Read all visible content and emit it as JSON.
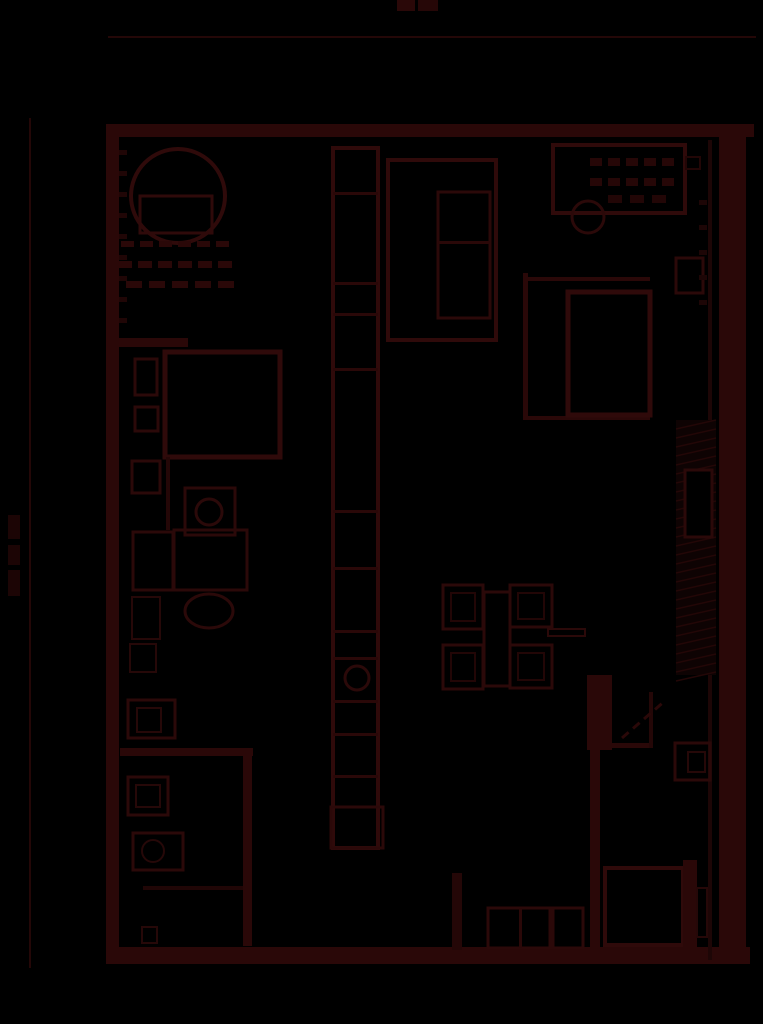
{
  "canvas": {
    "width": 763,
    "height": 1024,
    "background": "#000000"
  },
  "palette": {
    "wall_fill": "#2a0808",
    "line_strong": "#2f0a0a",
    "line_mid": "#2b0909",
    "line_soft": "#260808",
    "line_faint": "#1f0606",
    "hairline": "#240707",
    "blob": "#1c0505",
    "cavity_bg": "#0e0303"
  },
  "annotations": {
    "title_blob_legible": false,
    "left_dimension_label_legible": false
  },
  "shapes": [
    {
      "name": "title-blob-1",
      "kind": "rect",
      "x": 397,
      "y": 0,
      "w": 18,
      "h": 11,
      "f": "#2a0808"
    },
    {
      "name": "title-blob-2",
      "kind": "rect",
      "x": 418,
      "y": 0,
      "w": 20,
      "h": 11,
      "f": "#260707"
    },
    {
      "name": "top-dimension-rule",
      "kind": "rect",
      "x": 108,
      "y": 36,
      "w": 648,
      "h": 2,
      "f": "#240707"
    },
    {
      "name": "left-dimension-line",
      "kind": "rect",
      "x": 29,
      "y": 118,
      "w": 2,
      "h": 850,
      "f": "#240707"
    },
    {
      "name": "left-dimension-label-1",
      "kind": "rect",
      "x": 8,
      "y": 515,
      "w": 12,
      "h": 24,
      "f": "#1c0505"
    },
    {
      "name": "left-dimension-label-2",
      "kind": "rect",
      "x": 8,
      "y": 545,
      "w": 12,
      "h": 20,
      "f": "#1c0505"
    },
    {
      "name": "left-dimension-label-3",
      "kind": "rect",
      "x": 8,
      "y": 570,
      "w": 12,
      "h": 26,
      "f": "#1c0505"
    },
    {
      "name": "wall-top",
      "kind": "rect",
      "x": 108,
      "y": 124,
      "w": 646,
      "h": 13,
      "f": "#2a0808"
    },
    {
      "name": "wall-left",
      "kind": "rect",
      "x": 106,
      "y": 124,
      "w": 13,
      "h": 840,
      "f": "#2a0808"
    },
    {
      "name": "wall-bottom",
      "kind": "rect",
      "x": 106,
      "y": 947,
      "w": 644,
      "h": 17,
      "f": "#2a0808"
    },
    {
      "name": "wall-right",
      "kind": "rect",
      "x": 719,
      "y": 124,
      "w": 27,
      "h": 840,
      "f": "#2a0808"
    },
    {
      "name": "wall-right-inner-line",
      "kind": "rect",
      "x": 708,
      "y": 140,
      "w": 4,
      "h": 820,
      "f": "#1d0606"
    },
    {
      "name": "left-wall-hatch-ticks",
      "kind": "vdashrow",
      "x": 119,
      "y": 150,
      "n": 9,
      "dh": 5,
      "gap": 16,
      "w": 8,
      "f": "#200606"
    },
    {
      "name": "basin-circle",
      "kind": "circle",
      "cx": 178,
      "cy": 196,
      "r": 47,
      "s": "#2f0a0a",
      "sw": 4
    },
    {
      "name": "basin-counter",
      "kind": "rect",
      "x": 140,
      "y": 196,
      "w": 72,
      "h": 37,
      "s": "#2f0a0a",
      "sw": 3
    },
    {
      "name": "tile-dashes-row-1",
      "kind": "dashrow",
      "x": 121,
      "y": 241,
      "n": 6,
      "dw": 13,
      "gap": 6,
      "h": 6,
      "f": "#2a0808"
    },
    {
      "name": "tile-dashes-row-2",
      "kind": "dashrow",
      "x": 118,
      "y": 261,
      "n": 6,
      "dw": 14,
      "gap": 6,
      "h": 7,
      "f": "#2a0808"
    },
    {
      "name": "tile-dashes-row-3",
      "kind": "dashrow",
      "x": 126,
      "y": 281,
      "n": 5,
      "dw": 16,
      "gap": 7,
      "h": 7,
      "f": "#2a0808"
    },
    {
      "name": "partition-wall-a",
      "kind": "rect",
      "x": 118,
      "y": 338,
      "w": 70,
      "h": 9,
      "f": "#2a0808"
    },
    {
      "name": "closet-square",
      "kind": "rect",
      "x": 165,
      "y": 352,
      "w": 115,
      "h": 105,
      "s": "#2f0a0a",
      "sw": 5
    },
    {
      "name": "wall-shelf-1",
      "kind": "rect",
      "x": 135,
      "y": 359,
      "w": 22,
      "h": 36,
      "s": "#2b0909",
      "sw": 3
    },
    {
      "name": "wall-shelf-2",
      "kind": "rect",
      "x": 135,
      "y": 407,
      "w": 23,
      "h": 24,
      "s": "#2b0909",
      "sw": 3
    },
    {
      "name": "wall-shelf-3",
      "kind": "rect",
      "x": 132,
      "y": 461,
      "w": 28,
      "h": 32,
      "s": "#2b0909",
      "sw": 3
    },
    {
      "name": "closet-stem-line",
      "kind": "rect",
      "x": 166,
      "y": 457,
      "w": 4,
      "h": 73,
      "f": "#240707"
    },
    {
      "name": "fixture-box",
      "kind": "rect",
      "x": 185,
      "y": 488,
      "w": 50,
      "h": 47,
      "s": "#2b0909",
      "sw": 3
    },
    {
      "name": "fixture-box-circle",
      "kind": "circle",
      "cx": 209,
      "cy": 512,
      "r": 13,
      "s": "#2b0909",
      "sw": 3
    },
    {
      "name": "cabinet-1",
      "kind": "rect",
      "x": 133,
      "y": 532,
      "w": 40,
      "h": 58,
      "s": "#2b0909",
      "sw": 3
    },
    {
      "name": "cabinet-2",
      "kind": "rect",
      "x": 174,
      "y": 530,
      "w": 73,
      "h": 60,
      "s": "#2b0909",
      "sw": 3
    },
    {
      "name": "oval-fixture",
      "kind": "ellipse",
      "cx": 209,
      "cy": 611,
      "rx": 24,
      "ry": 17,
      "s": "#2b0909",
      "sw": 3
    },
    {
      "name": "cabinet-3",
      "kind": "rect",
      "x": 132,
      "y": 597,
      "w": 28,
      "h": 42,
      "s": "#260808",
      "sw": 2
    },
    {
      "name": "cabinet-4",
      "kind": "rect",
      "x": 130,
      "y": 644,
      "w": 26,
      "h": 28,
      "s": "#260808",
      "sw": 2
    },
    {
      "name": "partition-wall-b",
      "kind": "rect",
      "x": 120,
      "y": 748,
      "w": 133,
      "h": 8,
      "f": "#2a0808"
    },
    {
      "name": "partition-wall-c",
      "kind": "rect",
      "x": 243,
      "y": 756,
      "w": 9,
      "h": 190,
      "f": "#2a0808"
    },
    {
      "name": "washing-machine",
      "kind": "rect",
      "x": 128,
      "y": 700,
      "w": 47,
      "h": 38,
      "s": "#2b0909",
      "sw": 3
    },
    {
      "name": "washing-machine-drum",
      "kind": "rect",
      "x": 137,
      "y": 708,
      "w": 24,
      "h": 24,
      "s": "#260808",
      "sw": 2
    },
    {
      "name": "stove",
      "kind": "rect",
      "x": 128,
      "y": 777,
      "w": 40,
      "h": 38,
      "s": "#2b0909",
      "sw": 3
    },
    {
      "name": "stove-inner",
      "kind": "rect",
      "x": 136,
      "y": 785,
      "w": 24,
      "h": 22,
      "s": "#260808",
      "sw": 2
    },
    {
      "name": "kitchen-sink",
      "kind": "rect",
      "x": 133,
      "y": 833,
      "w": 50,
      "h": 37,
      "s": "#2b0909",
      "sw": 3
    },
    {
      "name": "kitchen-sink-bowl",
      "kind": "circle",
      "cx": 153,
      "cy": 851,
      "r": 11,
      "s": "#260808",
      "sw": 2
    },
    {
      "name": "counter-line",
      "kind": "rect",
      "x": 143,
      "y": 886,
      "w": 100,
      "h": 4,
      "f": "#200606"
    },
    {
      "name": "small-box",
      "kind": "rect",
      "x": 142,
      "y": 927,
      "w": 15,
      "h": 16,
      "s": "#260808",
      "sw": 2
    },
    {
      "name": "shaft-column",
      "kind": "rect",
      "x": 333,
      "y": 148,
      "w": 45,
      "h": 700,
      "s": "#2f0a0a",
      "sw": 4
    },
    {
      "name": "shaft-divider-1",
      "kind": "rect",
      "x": 333,
      "y": 192,
      "w": 45,
      "h": 3,
      "f": "#2a0808"
    },
    {
      "name": "shaft-divider-2",
      "kind": "rect",
      "x": 333,
      "y": 282,
      "w": 45,
      "h": 3,
      "f": "#2a0808"
    },
    {
      "name": "shaft-divider-3",
      "kind": "rect",
      "x": 333,
      "y": 313,
      "w": 45,
      "h": 3,
      "f": "#2a0808"
    },
    {
      "name": "shaft-divider-4",
      "kind": "rect",
      "x": 333,
      "y": 368,
      "w": 45,
      "h": 3,
      "f": "#2a0808"
    },
    {
      "name": "shaft-divider-5",
      "kind": "rect",
      "x": 333,
      "y": 510,
      "w": 45,
      "h": 3,
      "f": "#2a0808"
    },
    {
      "name": "shaft-divider-6",
      "kind": "rect",
      "x": 333,
      "y": 567,
      "w": 45,
      "h": 3,
      "f": "#2a0808"
    },
    {
      "name": "shaft-divider-7",
      "kind": "rect",
      "x": 333,
      "y": 630,
      "w": 45,
      "h": 3,
      "f": "#2a0808"
    },
    {
      "name": "shaft-divider-8",
      "kind": "rect",
      "x": 333,
      "y": 657,
      "w": 45,
      "h": 3,
      "f": "#2a0808"
    },
    {
      "name": "shaft-divider-9",
      "kind": "rect",
      "x": 333,
      "y": 700,
      "w": 45,
      "h": 3,
      "f": "#2a0808"
    },
    {
      "name": "shaft-divider-10",
      "kind": "rect",
      "x": 333,
      "y": 733,
      "w": 45,
      "h": 3,
      "f": "#2a0808"
    },
    {
      "name": "shaft-divider-11",
      "kind": "rect",
      "x": 333,
      "y": 775,
      "w": 45,
      "h": 3,
      "f": "#2a0808"
    },
    {
      "name": "shaft-circle",
      "kind": "circle",
      "cx": 357,
      "cy": 678,
      "r": 12,
      "s": "#2b0909",
      "sw": 3
    },
    {
      "name": "shaft-foot",
      "kind": "rect",
      "x": 331,
      "y": 807,
      "w": 52,
      "h": 41,
      "s": "#2b0909",
      "sw": 3
    },
    {
      "name": "wardrobe",
      "kind": "rect",
      "x": 388,
      "y": 160,
      "w": 108,
      "h": 180,
      "s": "#2f0a0a",
      "sw": 4
    },
    {
      "name": "wardrobe-inner",
      "kind": "rect",
      "x": 438,
      "y": 192,
      "w": 52,
      "h": 126,
      "s": "#2b0909",
      "sw": 3
    },
    {
      "name": "wardrobe-divider",
      "kind": "rect",
      "x": 438,
      "y": 241,
      "w": 52,
      "h": 3,
      "f": "#2a0808"
    },
    {
      "name": "bed",
      "kind": "rect",
      "x": 553,
      "y": 145,
      "w": 132,
      "h": 68,
      "s": "#2f0a0a",
      "sw": 4
    },
    {
      "name": "bed-pattern-row-1",
      "kind": "dashrow",
      "x": 590,
      "y": 158,
      "n": 5,
      "dw": 12,
      "gap": 6,
      "h": 8,
      "f": "#260707"
    },
    {
      "name": "bed-pattern-row-2",
      "kind": "dashrow",
      "x": 590,
      "y": 178,
      "n": 5,
      "dw": 12,
      "gap": 6,
      "h": 8,
      "f": "#260707"
    },
    {
      "name": "bed-pattern-row-3",
      "kind": "dashrow",
      "x": 608,
      "y": 195,
      "n": 3,
      "dw": 14,
      "gap": 8,
      "h": 8,
      "f": "#220606"
    },
    {
      "name": "round-stool",
      "kind": "circle",
      "cx": 588,
      "cy": 217,
      "r": 16,
      "s": "#2b0909",
      "sw": 3
    },
    {
      "name": "wall-notch",
      "kind": "rect",
      "x": 686,
      "y": 157,
      "w": 14,
      "h": 12,
      "s": "#220606",
      "sw": 2
    },
    {
      "name": "alcove-left-wall",
      "kind": "rect",
      "x": 523,
      "y": 273,
      "w": 5,
      "h": 147,
      "f": "#2a0808"
    },
    {
      "name": "alcove-top-line",
      "kind": "rect",
      "x": 528,
      "y": 277,
      "w": 122,
      "h": 4,
      "f": "#2a0808"
    },
    {
      "name": "alcove-bottom-line",
      "kind": "rect",
      "x": 528,
      "y": 416,
      "w": 122,
      "h": 4,
      "f": "#2a0808"
    },
    {
      "name": "shower-square",
      "kind": "rect",
      "x": 568,
      "y": 292,
      "w": 82,
      "h": 123,
      "s": "#2f0a0a",
      "sw": 5
    },
    {
      "name": "radiator",
      "kind": "rect",
      "x": 676,
      "y": 258,
      "w": 27,
      "h": 35,
      "s": "#2b0909",
      "sw": 3
    },
    {
      "name": "wall-cavity-hatch",
      "kind": "hatch",
      "x": 676,
      "y": 420,
      "w": 40,
      "h": 255,
      "step": 9,
      "s": "#230707",
      "bg": "#0e0303"
    },
    {
      "name": "wall-niche",
      "kind": "rect",
      "x": 685,
      "y": 470,
      "w": 27,
      "h": 67,
      "s": "#2b0909",
      "sw": 3,
      "f": "#000000"
    },
    {
      "name": "door-pier",
      "kind": "rect",
      "x": 587,
      "y": 675,
      "w": 25,
      "h": 75,
      "f": "#2a0808"
    },
    {
      "name": "door-head-wall",
      "kind": "rect",
      "x": 612,
      "y": 743,
      "w": 41,
      "h": 5,
      "f": "#2a0808"
    },
    {
      "name": "door-jamb",
      "kind": "rect",
      "x": 649,
      "y": 692,
      "w": 4,
      "h": 56,
      "f": "#240707"
    },
    {
      "name": "door-leaf",
      "kind": "diagdash",
      "x1": 622,
      "y1": 738,
      "x2": 666,
      "y2": 700,
      "n": 4,
      "s": "#2a0808",
      "sw": 3
    },
    {
      "name": "wall-panel",
      "kind": "rect",
      "x": 675,
      "y": 743,
      "w": 35,
      "h": 37,
      "s": "#2b0909",
      "sw": 3
    },
    {
      "name": "wall-panel-inner",
      "kind": "rect",
      "x": 688,
      "y": 752,
      "w": 17,
      "h": 20,
      "s": "#260808",
      "sw": 2
    },
    {
      "name": "partition-wall-d",
      "kind": "rect",
      "x": 590,
      "y": 750,
      "w": 10,
      "h": 200,
      "f": "#2a0808"
    },
    {
      "name": "chair-1",
      "kind": "rect",
      "x": 443,
      "y": 585,
      "w": 40,
      "h": 44,
      "s": "#2b0909",
      "sw": 3
    },
    {
      "name": "chair-1-seat",
      "kind": "rect",
      "x": 451,
      "y": 593,
      "w": 24,
      "h": 28,
      "s": "#220606",
      "sw": 2
    },
    {
      "name": "chair-2",
      "kind": "rect",
      "x": 443,
      "y": 645,
      "w": 40,
      "h": 44,
      "s": "#2b0909",
      "sw": 3
    },
    {
      "name": "chair-2-seat",
      "kind": "rect",
      "x": 451,
      "y": 653,
      "w": 24,
      "h": 28,
      "s": "#220606",
      "sw": 2
    },
    {
      "name": "chair-3",
      "kind": "rect",
      "x": 510,
      "y": 585,
      "w": 42,
      "h": 42,
      "s": "#2b0909",
      "sw": 3
    },
    {
      "name": "chair-3-seat",
      "kind": "rect",
      "x": 518,
      "y": 593,
      "w": 26,
      "h": 26,
      "s": "#220606",
      "sw": 2
    },
    {
      "name": "chair-4",
      "kind": "rect",
      "x": 510,
      "y": 645,
      "w": 42,
      "h": 43,
      "s": "#2b0909",
      "sw": 3
    },
    {
      "name": "chair-4-seat",
      "kind": "rect",
      "x": 518,
      "y": 653,
      "w": 26,
      "h": 27,
      "s": "#220606",
      "sw": 2
    },
    {
      "name": "dining-table",
      "kind": "rect",
      "x": 484,
      "y": 592,
      "w": 26,
      "h": 94,
      "s": "#2b0909",
      "sw": 3
    },
    {
      "name": "side-bar",
      "kind": "rect",
      "x": 548,
      "y": 629,
      "w": 37,
      "h": 7,
      "s": "#2b0909",
      "sw": 2
    },
    {
      "name": "door-post",
      "kind": "rect",
      "x": 452,
      "y": 873,
      "w": 10,
      "h": 77,
      "f": "#240707"
    },
    {
      "name": "low-cabinet-row",
      "kind": "rect",
      "x": 488,
      "y": 908,
      "w": 62,
      "h": 40,
      "s": "#2b0909",
      "sw": 3
    },
    {
      "name": "low-cabinet-divider",
      "kind": "rect",
      "x": 519,
      "y": 908,
      "w": 3,
      "h": 40,
      "f": "#2a0808"
    },
    {
      "name": "low-cabinet-2",
      "kind": "rect",
      "x": 553,
      "y": 908,
      "w": 30,
      "h": 40,
      "s": "#2b0909",
      "sw": 3
    },
    {
      "name": "lower-right-room",
      "kind": "rect",
      "x": 605,
      "y": 868,
      "w": 78,
      "h": 77,
      "s": "#2f0a0a",
      "sw": 4
    },
    {
      "name": "lower-right-band",
      "kind": "rect",
      "x": 683,
      "y": 860,
      "w": 14,
      "h": 88,
      "f": "#2a0808"
    },
    {
      "name": "narrow-box",
      "kind": "rect",
      "x": 697,
      "y": 888,
      "w": 10,
      "h": 49,
      "s": "#260808",
      "sw": 2
    },
    {
      "name": "right-wall-hatch-ticks",
      "kind": "vdashrow",
      "x": 699,
      "y": 200,
      "n": 5,
      "dh": 5,
      "gap": 20,
      "w": 8,
      "f": "#1d0606"
    }
  ]
}
